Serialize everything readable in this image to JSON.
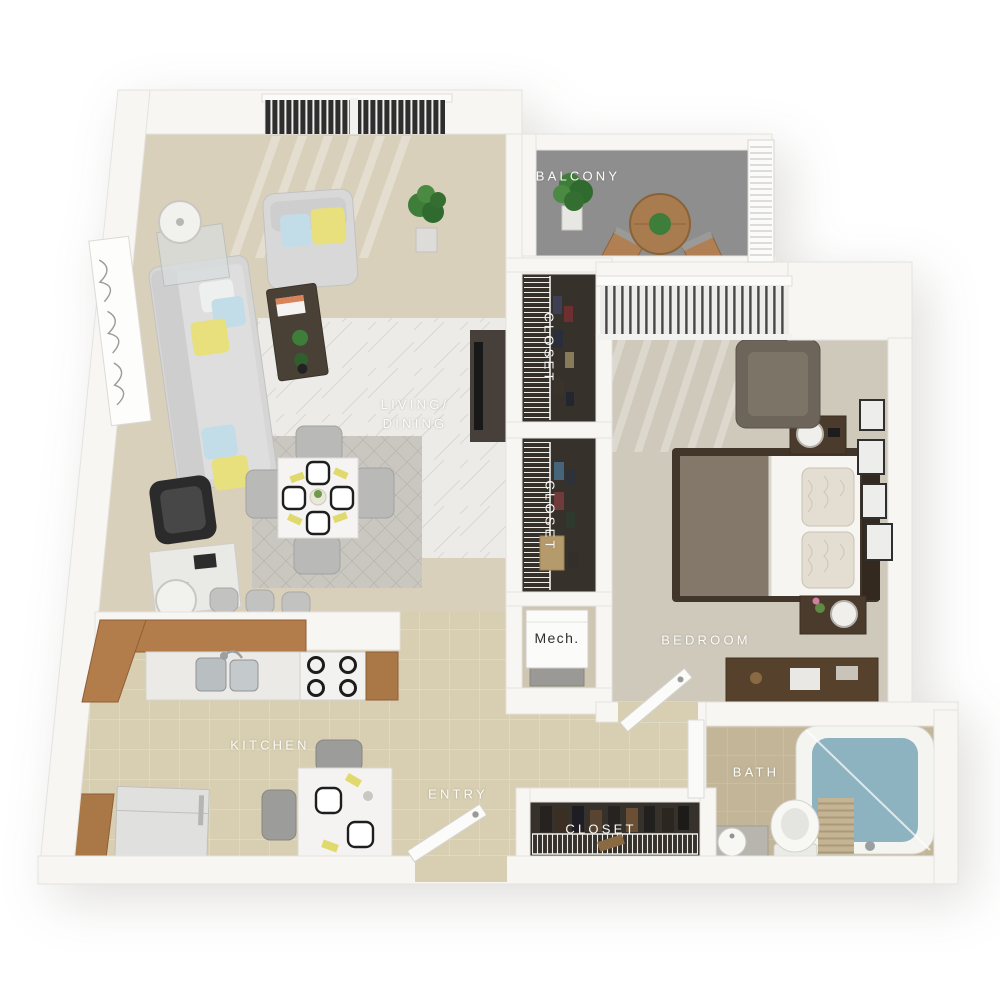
{
  "rooms": {
    "balcony": {
      "label": "BALCONY"
    },
    "closet_upper": {
      "label": "CLOSET"
    },
    "closet_middle": {
      "label": "CLOSET"
    },
    "living_dining": {
      "line1": "LIVING/",
      "line2": "DINING"
    },
    "bedroom": {
      "label": "BEDROOM"
    },
    "mech": {
      "label": "Mech."
    },
    "kitchen": {
      "label": "KITCHEN"
    },
    "entry": {
      "label": "ENTRY"
    },
    "bath": {
      "label": "BATH"
    },
    "closet_entry": {
      "label": "CLOSET"
    }
  },
  "colors": {
    "background": "#ffffff",
    "wall": "#f7f6f3",
    "wall_edge": "#e5e3df",
    "living_carpet": "#d9d0bc",
    "bedroom_carpet": "#cfc9bc",
    "balcony_floor": "#8e8e8e",
    "kitchen_tile": "#d8ceb1",
    "bath_tile": "#c2b598",
    "closet_interior": "#37312b",
    "mech_floor": "#cfc6b2",
    "wood": "#b27c4b",
    "dark_wood": "#4a3b2d",
    "sofa_gray": "#d6d6d6",
    "accent_yellow": "#e7e07d",
    "accent_blue": "#c2dde8",
    "tub_water": "#8db2c0",
    "label_text": "#fbfbf8",
    "mech_text": "#2e2e2e"
  }
}
